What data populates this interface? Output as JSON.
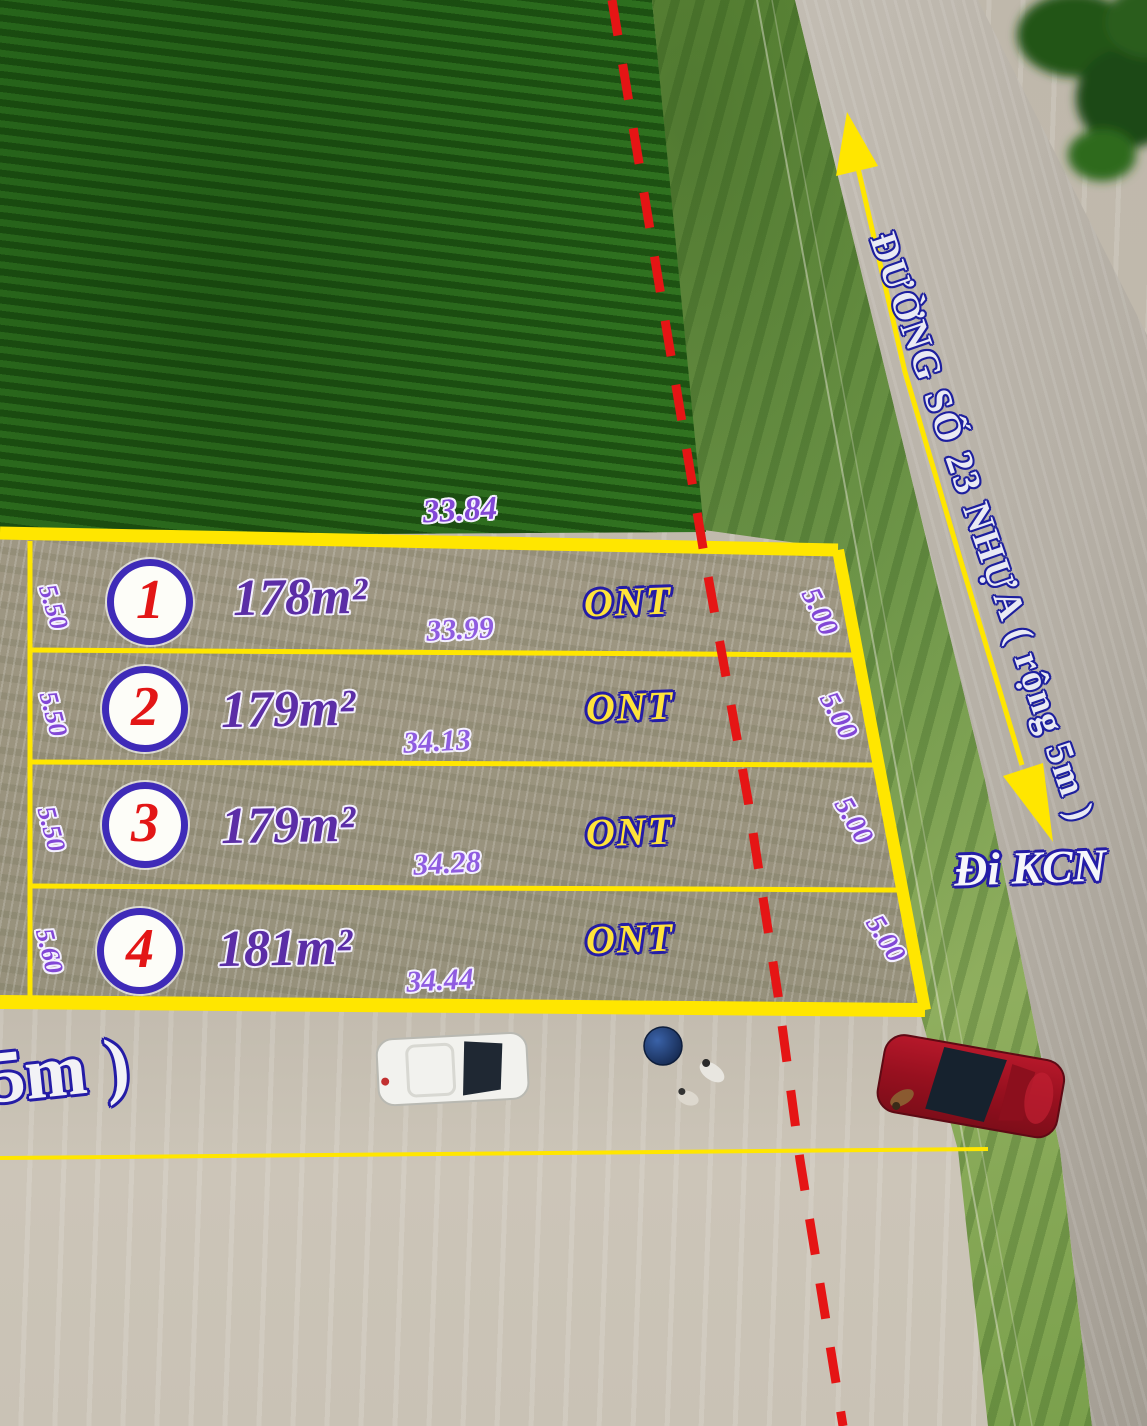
{
  "road": {
    "name": "ĐƯỜNG SỐ 23 NHỰA ( rộng 5m )",
    "direction": "Đi KCN",
    "bottom_label_partial": "5m )"
  },
  "top_edge_dim": "33.84",
  "plots": [
    {
      "number": "1",
      "area": "178m²",
      "zoning": "ONT",
      "bottom_dim": "33.99",
      "left_dim": "5.50",
      "right_dim": "5.00"
    },
    {
      "number": "2",
      "area": "179m²",
      "zoning": "ONT",
      "bottom_dim": "34.13",
      "left_dim": "5.50",
      "right_dim": "5.00"
    },
    {
      "number": "3",
      "area": "179m²",
      "zoning": "ONT",
      "bottom_dim": "34.28",
      "left_dim": "5.50",
      "right_dim": "5.00"
    },
    {
      "number": "4",
      "area": "181m²",
      "zoning": "ONT",
      "bottom_dim": "34.44",
      "left_dim": "5.60",
      "right_dim": "5.00"
    }
  ],
  "colors": {
    "boundary_yellow": "#ffe600",
    "dashed_red": "#e51515",
    "dim_purple": "#8247d6",
    "area_purple": "#5b2da6",
    "plot_number_red": "#e31616",
    "circle_ring_indigo": "#3f2bb8",
    "ont_yellow": "#ffe43a",
    "outline_blue": "#241ca6",
    "road_label_fill": "#e9eaf4"
  }
}
